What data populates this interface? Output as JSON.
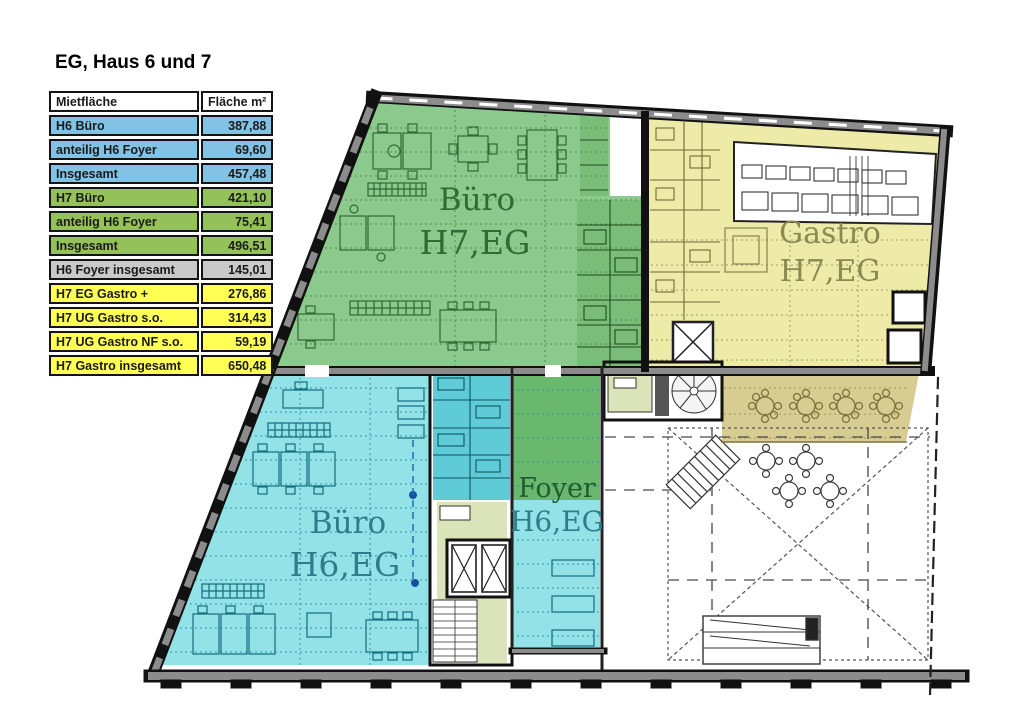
{
  "title": "EG, Haus 6 und 7",
  "table": {
    "col1": "Mietfläche",
    "col2": "Fläche m²",
    "colors": {
      "blue": "#82c2e2",
      "green": "#95c258",
      "gray": "#c9c9c9",
      "yellow": "#ffff55",
      "header": "#ffffff"
    },
    "rows": [
      {
        "label": "H6 Büro",
        "value": "387,88",
        "group": "blue"
      },
      {
        "label": "anteilig H6 Foyer",
        "value": "69,60",
        "group": "blue"
      },
      {
        "label": "Insgesamt",
        "value": "457,48",
        "group": "blue"
      },
      {
        "label": "H7 Büro",
        "value": "421,10",
        "group": "green"
      },
      {
        "label": "anteilig H6 Foyer",
        "value": "75,41",
        "group": "green"
      },
      {
        "label": "Insgesamt",
        "value": "496,51",
        "group": "green"
      },
      {
        "label": "H6 Foyer insgesamt",
        "value": "145,01",
        "group": "gray"
      },
      {
        "label": "H7 EG Gastro +",
        "value": "276,86",
        "group": "yellow"
      },
      {
        "label": "H7 UG Gastro s.o.",
        "value": "314,43",
        "group": "yellow"
      },
      {
        "label": "H7 UG Gastro NF s.o.",
        "value": "59,19",
        "group": "yellow"
      },
      {
        "label": "H7 Gastro insgesamt",
        "value": "650,48",
        "group": "yellow"
      }
    ]
  },
  "plan": {
    "colors": {
      "h7_buero": "#8cc98c",
      "h7_rooms": "#79bd79",
      "gastro": "#eeeaa8",
      "h6_buero": "#92e2e8",
      "h6_rooms": "#5ecbd6",
      "foyer": "#6ab86d",
      "terrace": "#d7cc92",
      "lobby": "#dbe3b8",
      "wall_gray": "#8c8c8c"
    },
    "zones": [
      {
        "id": "h7-buero",
        "line1": "Büro",
        "line2": "H7,EG",
        "text_color": "#2f6b33"
      },
      {
        "id": "gastro",
        "line1": "Gastro",
        "line2": "H7,EG",
        "text_color": "#8a8a52"
      },
      {
        "id": "h6-buero",
        "line1": "Büro",
        "line2": "H6,EG",
        "text_color": "#2e7d8c"
      },
      {
        "id": "foyer",
        "line1": "Foyer",
        "line2": "H6,EG",
        "text_color": "#1f5c2f",
        "line2_color": "#2e7d8c"
      }
    ]
  }
}
